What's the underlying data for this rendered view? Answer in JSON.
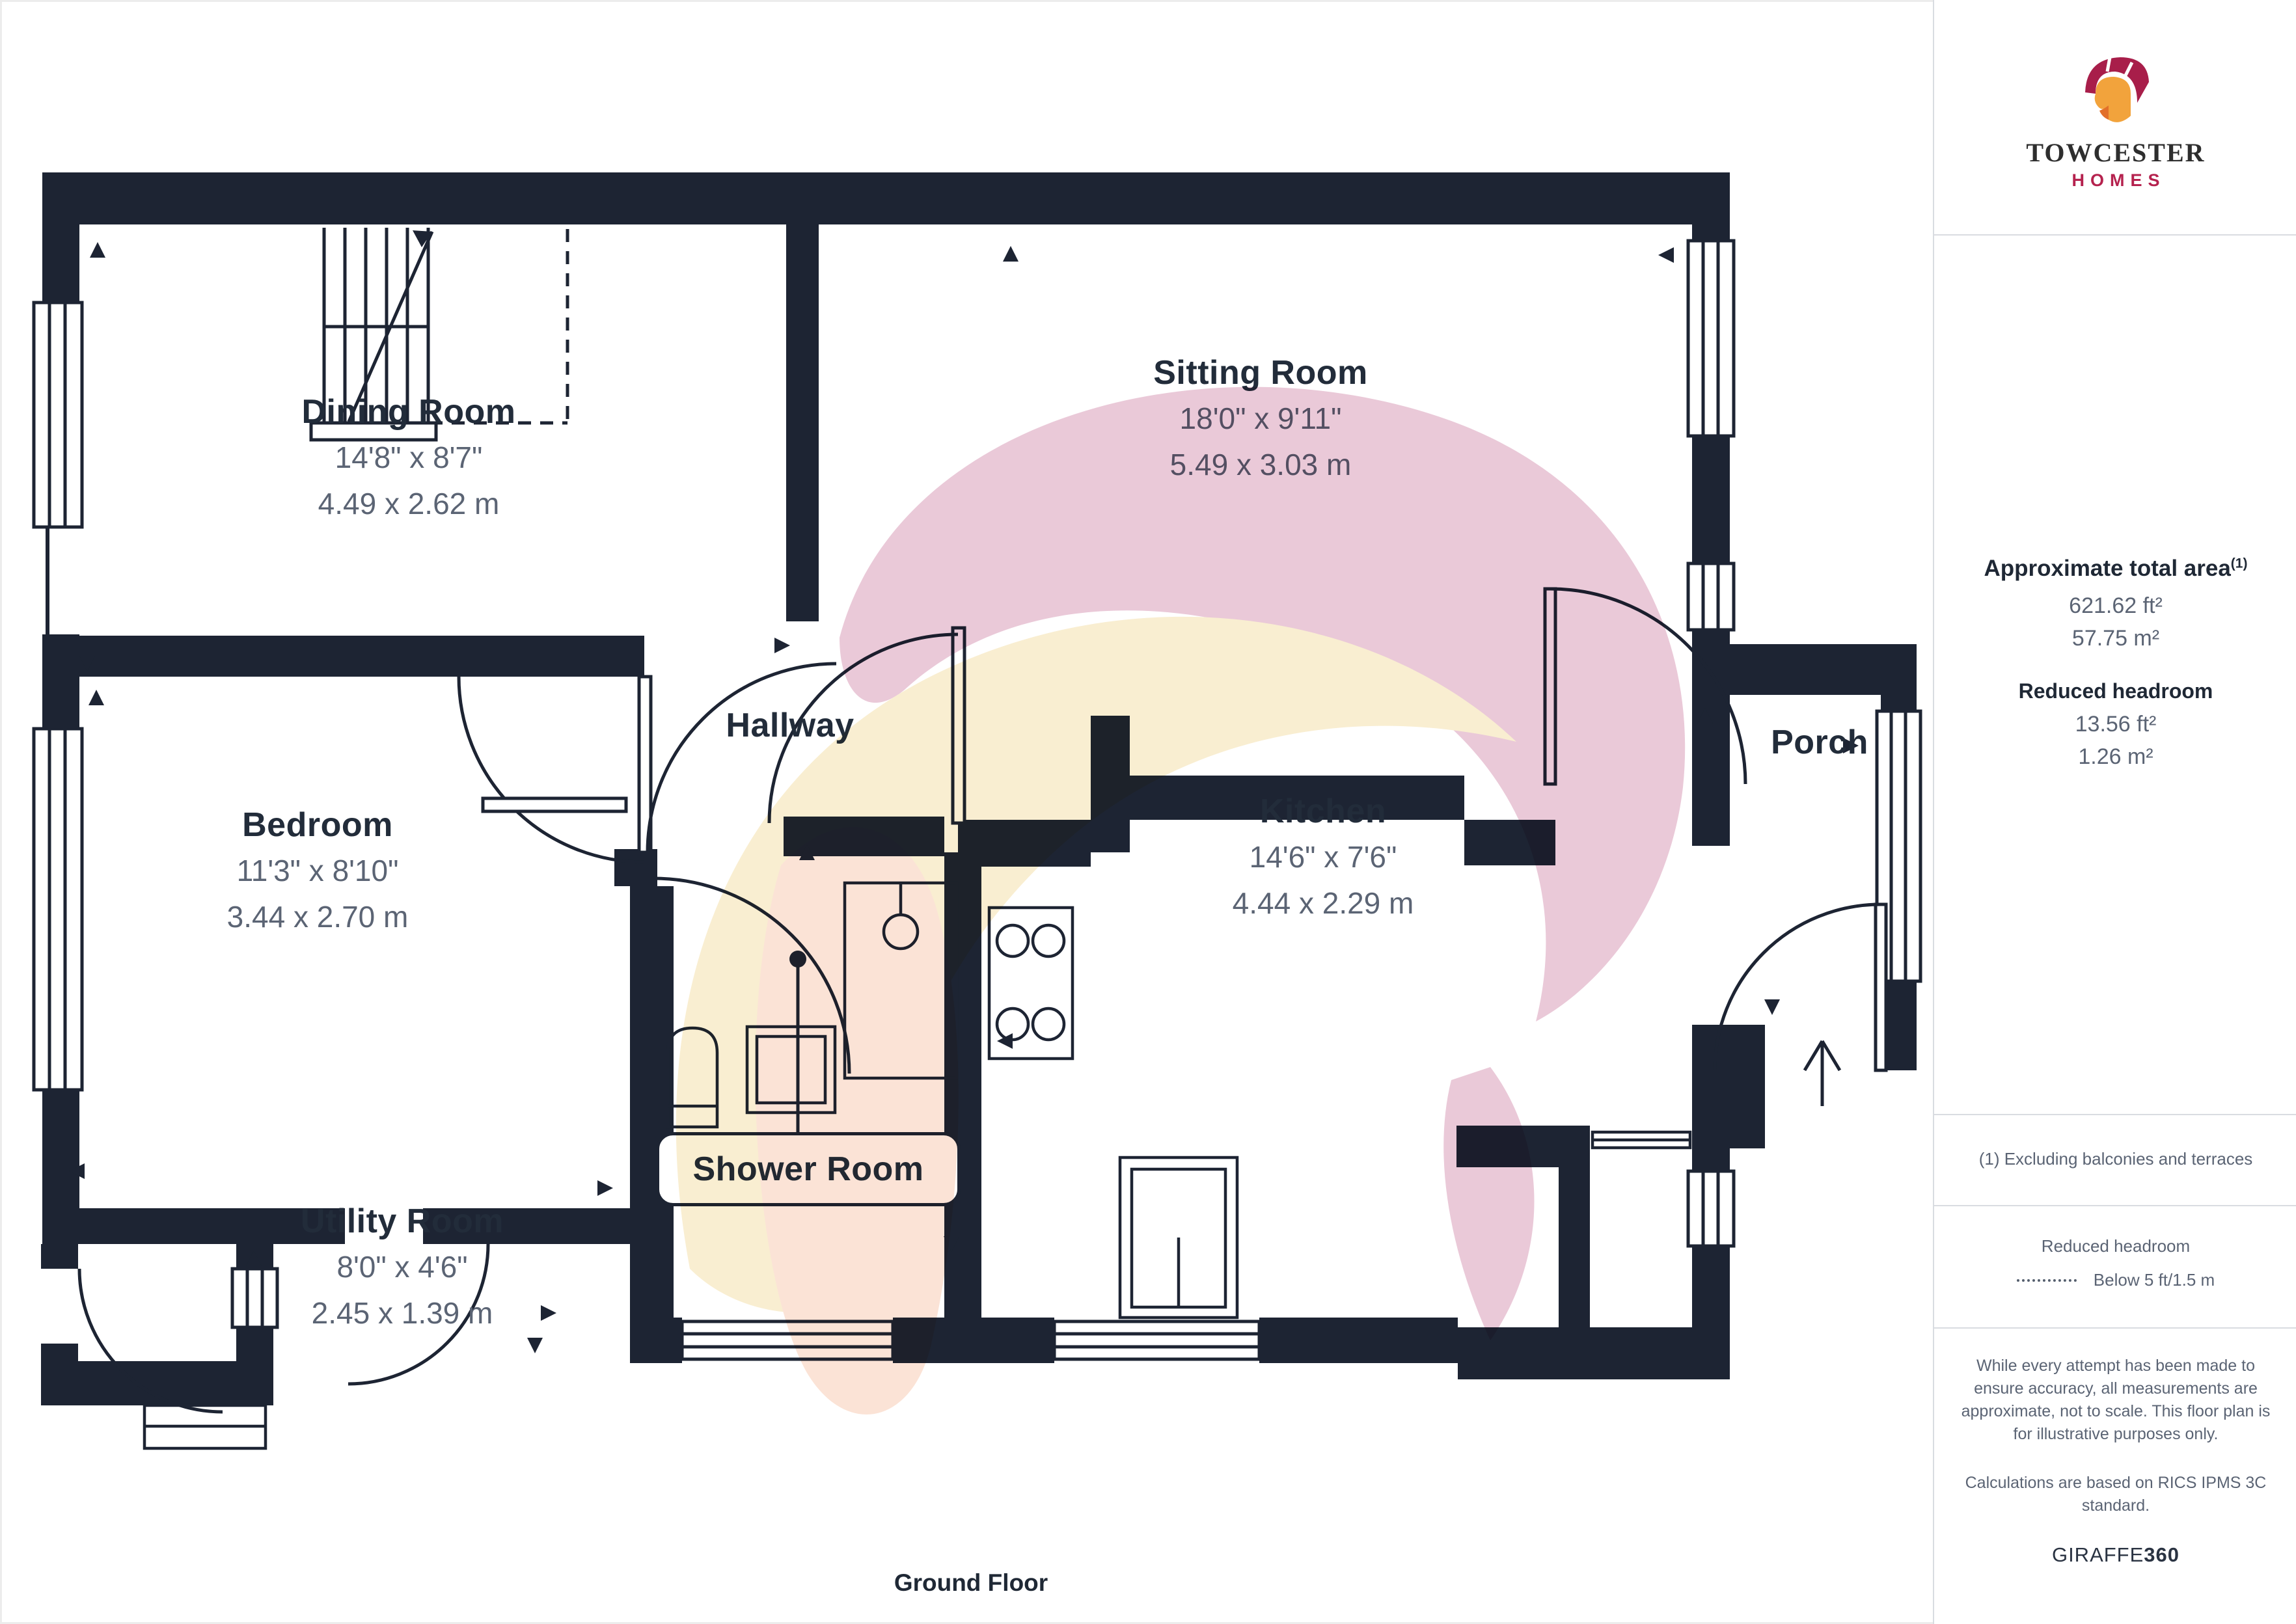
{
  "branding": {
    "name_top": "TOWCESTER",
    "name_bottom": "HOMES"
  },
  "floor": {
    "label": "Ground Floor"
  },
  "rooms": [
    {
      "name": "Dining Room",
      "imperial": "14'8\" x 8'7\"",
      "metric": "4.49 x 2.62 m"
    },
    {
      "name": "Sitting Room",
      "imperial": "18'0\" x 9'11\"",
      "metric": "5.49 x 3.03 m"
    },
    {
      "name": "Bedroom",
      "imperial": "11'3\" x 8'10\"",
      "metric": "3.44 x 2.70 m"
    },
    {
      "name": "Kitchen",
      "imperial": "14'6\" x 7'6\"",
      "metric": "4.44 x 2.29 m"
    },
    {
      "name": "Utility Room",
      "imperial": "8'0\" x 4'6\"",
      "metric": "2.45 x 1.39 m"
    },
    {
      "name": "Hallway"
    },
    {
      "name": "Porch"
    },
    {
      "name": "Shower Room"
    }
  ],
  "sidebar": {
    "heading": "Approximate total area",
    "heading_sup": "(1)",
    "total_ft": "621.62 ft²",
    "total_m": "57.75 m²",
    "reduced_heading": "Reduced headroom",
    "reduced_ft": "13.56 ft²",
    "reduced_m": "1.26 m²",
    "note": "(1) Excluding balconies and terraces",
    "legend_title": "Reduced headroom",
    "legend_label": "Below 5 ft/1.5 m",
    "disclaimer1": "While every attempt has been made to ensure accuracy, all measurements are approximate, not to scale. This floor plan is for illustrative purposes only.",
    "disclaimer2": "Calculations are based on RICS IPMS 3C standard.",
    "brand_normal": "GIRAFFE",
    "brand_bold": "360"
  },
  "colors": {
    "wall": "#1d2433",
    "accent_crimson": "#b5224e",
    "accent_orange": "#f2a33c",
    "text_dark": "#222c3a",
    "text_dim": "#5b6474",
    "watermark_pink": "#e9c6d6",
    "watermark_cream": "#f9edcf",
    "watermark_peach": "#fbe2d4"
  }
}
